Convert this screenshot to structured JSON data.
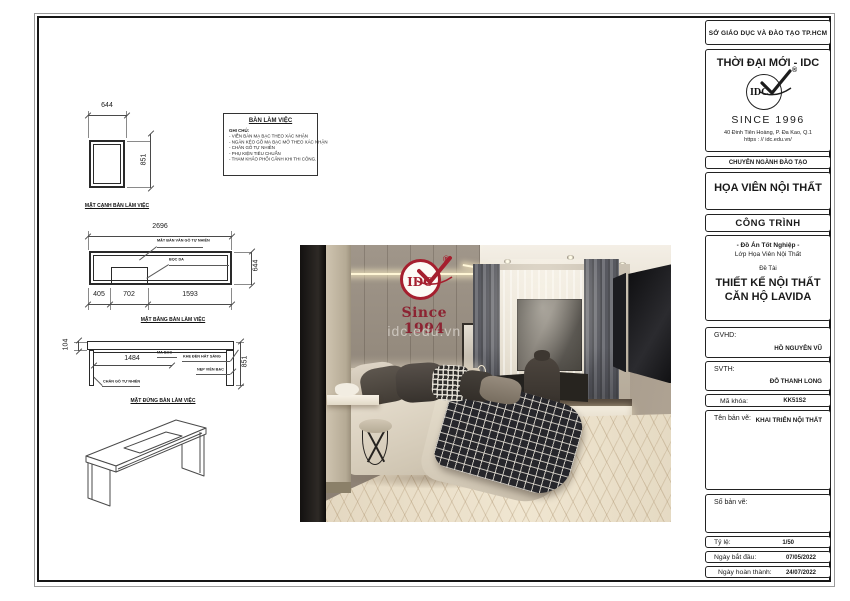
{
  "titleblock": {
    "department": "SỞ GIÁO DỤC VÀ ĐÀO TẠO TP.HCM",
    "brand": "THỜI ĐẠI MỚI - IDC",
    "logo_text": "IDC",
    "registered": "®",
    "since": "SINCE 1996",
    "address1": "40 Đinh Tiên Hoàng, P. Đa Kao, Q.1",
    "address2": "https : // idc.edu.vn/",
    "training_header": "CHUYÊN NGÀNH ĐÀO TẠO",
    "major": "HỌA VIÊN NỘI THẤT",
    "project_header": "CÔNG TRÌNH",
    "project_sub1": "- Đồ Án Tốt Nghiệp -",
    "project_sub2": "Lớp Họa Viên Nội Thất",
    "topic_label": "Đề Tài",
    "topic_line1": "THIẾT KẾ NỘI THẤT",
    "topic_line2": "CĂN HỘ LAVIDA",
    "gvhd_label": "GVHD:",
    "gvhd_value": "HỒ NGUYÊN VŨ",
    "svth_label": "SVTH:",
    "svth_value": "ĐỖ THANH LONG",
    "makhoa_label": "Mã khóa:",
    "makhoa_value": "KK51S2",
    "tenbanve_label": "Tên bản vẽ:",
    "tenbanve_value": "KHAI TRIỂN NỘI THẤT",
    "sobanve_label": "Số bản vẽ:",
    "tyle_label": "Tỷ lệ:",
    "tyle_value": "1/50",
    "start_label": "Ngày bắt đầu:",
    "start_value": "07/05/2022",
    "finish_label": "Ngày hoàn thành:",
    "finish_value": "24/07/2022"
  },
  "notes": {
    "title": "BÀN LÀM VIỆC",
    "heading": "GHI CHÚ:",
    "items": [
      "- VIỀN BÀN MẠ BẠC THEO XÁC NHẬN",
      "- NGĂN KÉO GỖ MẠ BẠC MỞ THEO XÁC NHẬN",
      "- CHÂN GỖ TỰ NHIÊN",
      "- PHỤ KIỆN TIÊU CHUẨN",
      "- THAM KHẢO PHỐI CẢNH KHI THI CÔNG."
    ]
  },
  "drawings": {
    "side": {
      "label": "MẶT CẠNH BÀN LÀM VIỆC",
      "w": "644",
      "h": "851"
    },
    "plan": {
      "label": "MẶT BẰNG BÀN LÀM VIỆC",
      "total": "2696",
      "depth": "644",
      "d1": "405",
      "d2": "702",
      "d3": "1593",
      "callout1": "MẶT BÀN VÂN GỖ TỰ NHIÊN",
      "callout2": "BỌC DA"
    },
    "elev": {
      "label": "MẶT ĐỨNG BÀN LÀM VIỆC",
      "top": "104",
      "inner": "1484",
      "h": "851",
      "callout1": "MẠ BẠC",
      "callout2": "KHE ĐÈN HẮT SÁNG",
      "callout3": "NẸP VIỀN BẠC",
      "callout4": "CHÂN GỖ TỰ NHIÊN"
    }
  },
  "watermark": {
    "logo_text": "IDC",
    "registered": "®",
    "since": "Since 1994",
    "url": "idc.edu.vn"
  },
  "colors": {
    "logo_red": "#A51F2E",
    "since_red": "#8C2332",
    "line": "#3A3A3A"
  }
}
